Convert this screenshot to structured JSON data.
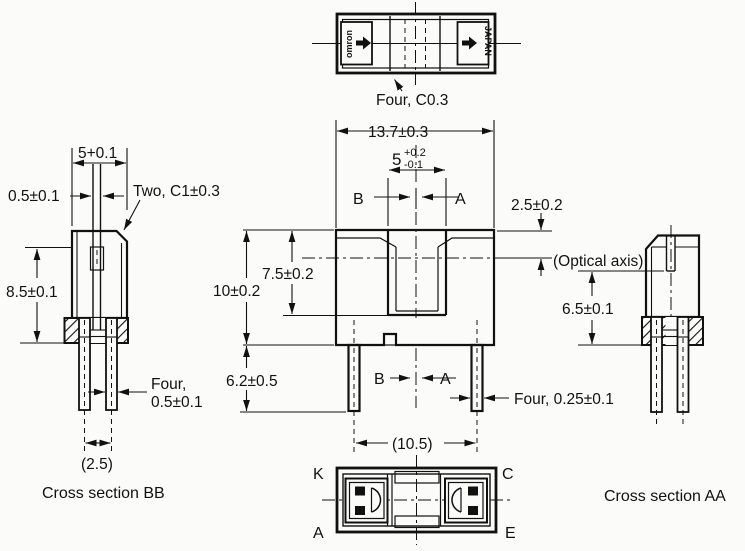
{
  "top_view": {
    "brand": "omron",
    "origin": "JAPAN",
    "chamfer_note": "Four, C0.3"
  },
  "dims": {
    "overall_width": "13.7±0.3",
    "slot_width_nominal": "5",
    "slot_width_tol_plus": "+0.2",
    "slot_width_tol_minus": "-0.1",
    "optical_axis_offset": "2.5±0.2",
    "bb_width": "5+0.1",
    "bb_slit": "0.5±0.1",
    "chamfer_note": "Two, C1±0.3",
    "bb_height": "8.5±0.1",
    "overall_height": "10±0.2",
    "slot_depth": "7.5±0.2",
    "lead_length": "6.2±0.5",
    "lead_thickness_line1": "Four,",
    "lead_thickness_line2": "0.5±0.1",
    "lead_width": "Four, 0.25±0.1",
    "lead_span": "(10.5)",
    "bb_lead_pitch": "(2.5)",
    "aa_optical_height": "6.5±0.1"
  },
  "annotations": {
    "optical_axis": "(Optical axis)"
  },
  "sections": {
    "bb_caption": "Cross section BB",
    "aa_caption": "Cross section AA",
    "marker_b": "B",
    "marker_a": "A"
  },
  "pins": {
    "top_left": "K",
    "top_right": "C",
    "bottom_left": "A",
    "bottom_right": "E"
  },
  "colors": {
    "ink": "#111111",
    "paper": "#fbfbfa"
  }
}
